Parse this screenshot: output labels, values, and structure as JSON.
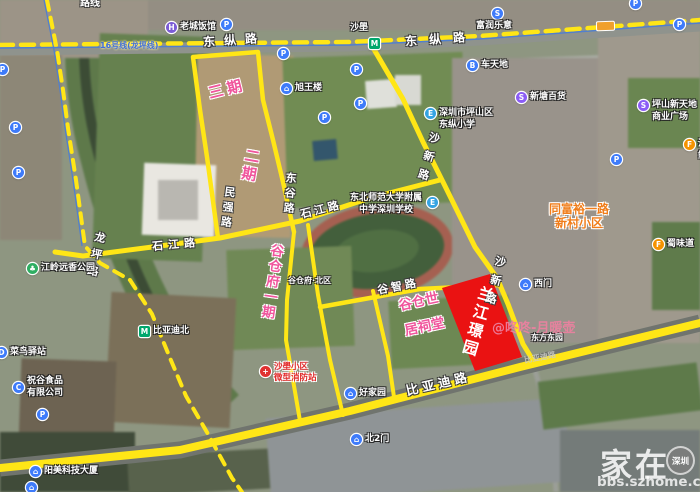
{
  "icons": {
    "parking": "P",
    "metro": "M",
    "hotel": "H",
    "shop": "S",
    "bus": "B",
    "school": "E",
    "park": "♣",
    "company": "C",
    "delivery": "D",
    "food": "F",
    "gate": "⌂",
    "fire": "+"
  },
  "colors": {
    "road_yellow": "#ffe616",
    "parcel_red": "#ea1212",
    "phase_pink": "#f0559c",
    "estate_orange": "#f07d1a",
    "metro_blue": "#4f7fd0"
  },
  "metro": {
    "line_label": "16号线(龙坪线)",
    "station_shabo": "沙壆",
    "station_bydbei": "比亚迪北"
  },
  "corner_label": "路线",
  "road_labels": {
    "dongzong": "东纵路",
    "shaxin": "沙新路",
    "minqiang": "民强路",
    "donggu": "东谷路",
    "shijiang": "石江路",
    "longping": "龙坪路",
    "guzhi": "谷智路",
    "biyadi": "比亚迪路"
  },
  "phase_labels": {
    "phase3": "三期",
    "phase2": "二期",
    "gucangfu_phase1": "谷仓府一期",
    "gucangfu_north": "谷仓府·北区",
    "gucang_shiju_line1": "谷仓世",
    "gucang_shiju_line2": "居祠堂"
  },
  "red_parcel": {
    "name": "兰江璟园"
  },
  "pois": {
    "hotel": "老城饭馆",
    "xuwanglou": "旭王楼",
    "furun": "富润乐意",
    "chetiandi": "车天地",
    "xintang": "新塘百货",
    "pingshan_plaza_1": "坪山新天地",
    "pingshan_plaza_2": "商业广场",
    "dongzong_school_1": "深圳市坪山区",
    "dongzong_school_2": "东纵小学",
    "neu_school_1": "东北师范大学附属",
    "neu_school_2": "中学深圳学校",
    "tongfuyu_1": "同富裕一路",
    "tongfuyu_2": "新村小区",
    "jiangling_park": "江岭远香公园",
    "cainiao": "菜鸟驿站",
    "zhugu_1": "祝谷食品",
    "zhugu_2": "有限公司",
    "yangmei": "阳美科技大厦",
    "ximen": "西门",
    "dongfang": "东方东园",
    "haojiayuan": "好家园",
    "bei2men": "北2门",
    "fire_1": "沙壆小区",
    "fire_2": "微型消防站",
    "shuweidao": "蜀味道",
    "hexian": "河鲜"
  },
  "watermarks": {
    "user": "@咚咚-月暖壶",
    "brand": "家在",
    "brand_badge": "深圳",
    "url": "bbs.szhome.com"
  }
}
